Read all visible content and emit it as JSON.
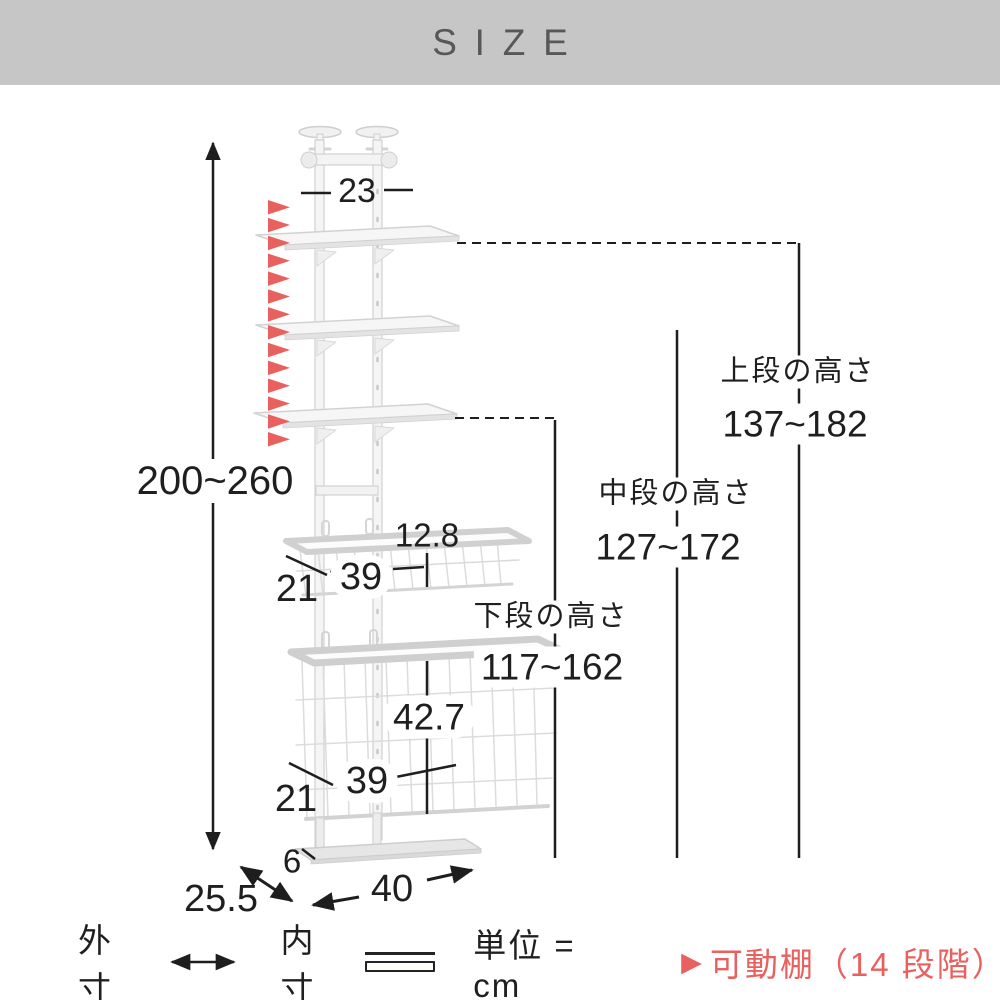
{
  "header": {
    "title": "SIZE"
  },
  "diagram": {
    "overall_height": "200~260",
    "top_width": "23",
    "movable_positions": 14,
    "upper_basket": {
      "height": "12.8",
      "width": "39",
      "depth": "21"
    },
    "lower_basket": {
      "height": "42.7",
      "width": "39",
      "depth": "21"
    },
    "base": {
      "height": "6",
      "width": "40",
      "depth": "25.5"
    },
    "levels": {
      "top": {
        "label": "上段の高さ",
        "range": "137~182"
      },
      "middle": {
        "label": "中段の高さ",
        "range": "127~172"
      },
      "bottom": {
        "label": "下段の高さ",
        "range": "117~162"
      }
    }
  },
  "legend": {
    "outer_label": "外寸",
    "inner_label": "内寸",
    "unit_label": "単位 = cm",
    "movable_marker": "▶",
    "movable_label": "可動棚（14 段階）"
  },
  "colors": {
    "accent_red": "#e8615e",
    "header_bg": "#c6c6c6",
    "line": "#1e1e1e"
  }
}
